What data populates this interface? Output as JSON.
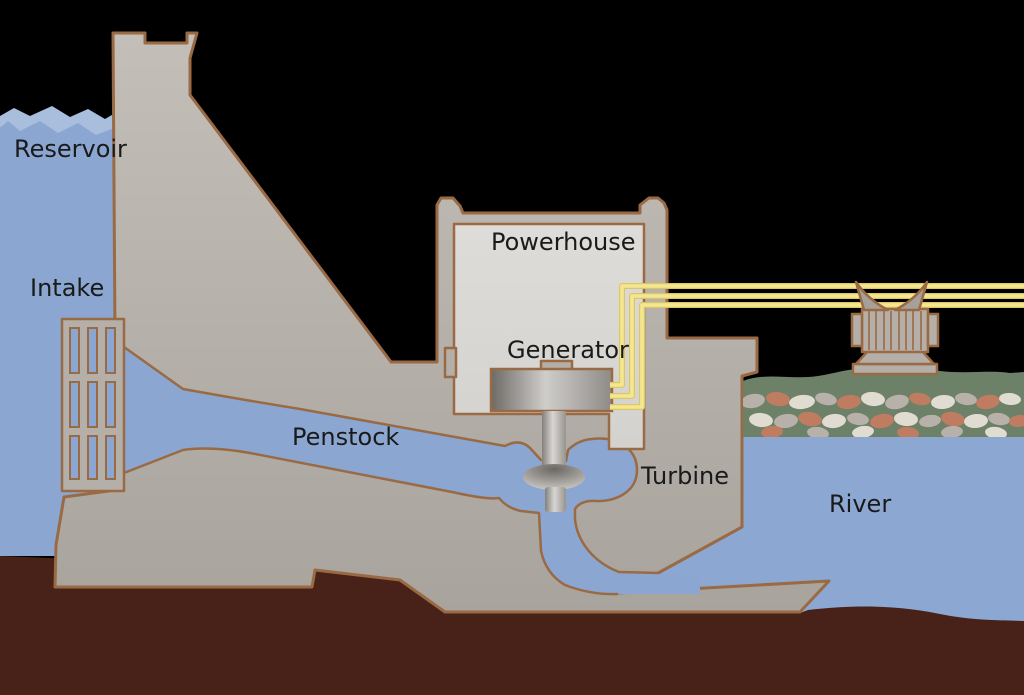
{
  "labels": {
    "reservoir": "Reservoir",
    "intake": "Intake",
    "powerhouse": "Powerhouse",
    "generator": "Generator",
    "penstock": "Penstock",
    "turbine": "Turbine",
    "river": "River"
  },
  "label_positions": {
    "reservoir": {
      "x": 14,
      "y": 157
    },
    "intake": {
      "x": 30,
      "y": 296
    },
    "powerhouse": {
      "x": 491,
      "y": 250
    },
    "generator": {
      "x": 507,
      "y": 358
    },
    "penstock": {
      "x": 292,
      "y": 445
    },
    "turbine": {
      "x": 641,
      "y": 484
    },
    "river": {
      "x": 829,
      "y": 512
    }
  },
  "colors": {
    "sky": "#000000",
    "water": "#8BA7D1",
    "wave": "#A9BEDD",
    "river": "#8CA8D2",
    "earth": "#482218",
    "bank": "#6D8168",
    "concrete": "#B4B0A9",
    "interior": "#DBD9D5",
    "outline": "#9A6A44",
    "wire": "#F5E78E",
    "wire-edge": "#DCC66A",
    "text": "#1A1A1A"
  },
  "wires": [
    {
      "stub_y": 385,
      "bend_x": 622,
      "line_y": 286
    },
    {
      "stub_y": 396,
      "bend_x": 632,
      "line_y": 296
    },
    {
      "stub_y": 407,
      "bend_x": 642,
      "line_y": 305
    }
  ],
  "grate": {
    "cols": [
      70,
      88,
      106
    ],
    "col_width": 9,
    "rows": [
      {
        "y": 328,
        "h": 45
      },
      {
        "y": 382,
        "h": 45
      },
      {
        "y": 436,
        "h": 43
      }
    ]
  },
  "tower": {
    "rib_xs": [
      869,
      876,
      884,
      891,
      899,
      906,
      913,
      921
    ]
  },
  "pebbles": [
    {
      "cx": 753,
      "cy": 401,
      "rx": 12,
      "ry": 7,
      "rot": -10,
      "c": "#B7B1A9"
    },
    {
      "cx": 778,
      "cy": 399,
      "rx": 12,
      "ry": 7,
      "rot": 8,
      "c": "#BF7C60"
    },
    {
      "cx": 802,
      "cy": 402,
      "rx": 13,
      "ry": 7,
      "rot": -6,
      "c": "#E0DCD1"
    },
    {
      "cx": 826,
      "cy": 399,
      "rx": 11,
      "ry": 6,
      "rot": 12,
      "c": "#B7B1A9"
    },
    {
      "cx": 849,
      "cy": 402,
      "rx": 12,
      "ry": 7,
      "rot": -8,
      "c": "#BF7C60"
    },
    {
      "cx": 873,
      "cy": 399,
      "rx": 12,
      "ry": 7,
      "rot": 6,
      "c": "#E0DCD1"
    },
    {
      "cx": 897,
      "cy": 402,
      "rx": 12,
      "ry": 7,
      "rot": -12,
      "c": "#B7B1A9"
    },
    {
      "cx": 920,
      "cy": 399,
      "rx": 11,
      "ry": 6,
      "rot": 10,
      "c": "#BF7C60"
    },
    {
      "cx": 943,
      "cy": 402,
      "rx": 12,
      "ry": 7,
      "rot": -5,
      "c": "#E0DCD1"
    },
    {
      "cx": 966,
      "cy": 399,
      "rx": 11,
      "ry": 6,
      "rot": 8,
      "c": "#B7B1A9"
    },
    {
      "cx": 988,
      "cy": 402,
      "rx": 12,
      "ry": 7,
      "rot": -10,
      "c": "#BF7C60"
    },
    {
      "cx": 1010,
      "cy": 399,
      "rx": 11,
      "ry": 6,
      "rot": 5,
      "c": "#E0DCD1"
    },
    {
      "cx": 761,
      "cy": 420,
      "rx": 12,
      "ry": 7,
      "rot": 6,
      "c": "#E0DCD1"
    },
    {
      "cx": 786,
      "cy": 421,
      "rx": 12,
      "ry": 7,
      "rot": -8,
      "c": "#B7B1A9"
    },
    {
      "cx": 810,
      "cy": 419,
      "rx": 12,
      "ry": 7,
      "rot": 10,
      "c": "#BF7C60"
    },
    {
      "cx": 834,
      "cy": 421,
      "rx": 12,
      "ry": 7,
      "rot": -6,
      "c": "#E0DCD1"
    },
    {
      "cx": 858,
      "cy": 419,
      "rx": 11,
      "ry": 6,
      "rot": 8,
      "c": "#B7B1A9"
    },
    {
      "cx": 882,
      "cy": 421,
      "rx": 12,
      "ry": 7,
      "rot": -10,
      "c": "#BF7C60"
    },
    {
      "cx": 906,
      "cy": 419,
      "rx": 12,
      "ry": 7,
      "rot": 5,
      "c": "#E0DCD1"
    },
    {
      "cx": 930,
      "cy": 421,
      "rx": 11,
      "ry": 6,
      "rot": -8,
      "c": "#B7B1A9"
    },
    {
      "cx": 953,
      "cy": 419,
      "rx": 12,
      "ry": 7,
      "rot": 10,
      "c": "#BF7C60"
    },
    {
      "cx": 976,
      "cy": 421,
      "rx": 12,
      "ry": 7,
      "rot": -5,
      "c": "#E0DCD1"
    },
    {
      "cx": 999,
      "cy": 419,
      "rx": 11,
      "ry": 6,
      "rot": 8,
      "c": "#B7B1A9"
    },
    {
      "cx": 1019,
      "cy": 421,
      "rx": 10,
      "ry": 6,
      "rot": -6,
      "c": "#BF7C60"
    },
    {
      "cx": 772,
      "cy": 432,
      "rx": 11,
      "ry": 6,
      "rot": -6,
      "c": "#BF7C60"
    },
    {
      "cx": 818,
      "cy": 433,
      "rx": 11,
      "ry": 6,
      "rot": 8,
      "c": "#B7B1A9"
    },
    {
      "cx": 863,
      "cy": 432,
      "rx": 11,
      "ry": 6,
      "rot": -8,
      "c": "#E0DCD1"
    },
    {
      "cx": 908,
      "cy": 433,
      "rx": 11,
      "ry": 6,
      "rot": 6,
      "c": "#BF7C60"
    },
    {
      "cx": 952,
      "cy": 432,
      "rx": 11,
      "ry": 6,
      "rot": -6,
      "c": "#B7B1A9"
    },
    {
      "cx": 996,
      "cy": 433,
      "rx": 11,
      "ry": 6,
      "rot": 8,
      "c": "#E0DCD1"
    }
  ]
}
